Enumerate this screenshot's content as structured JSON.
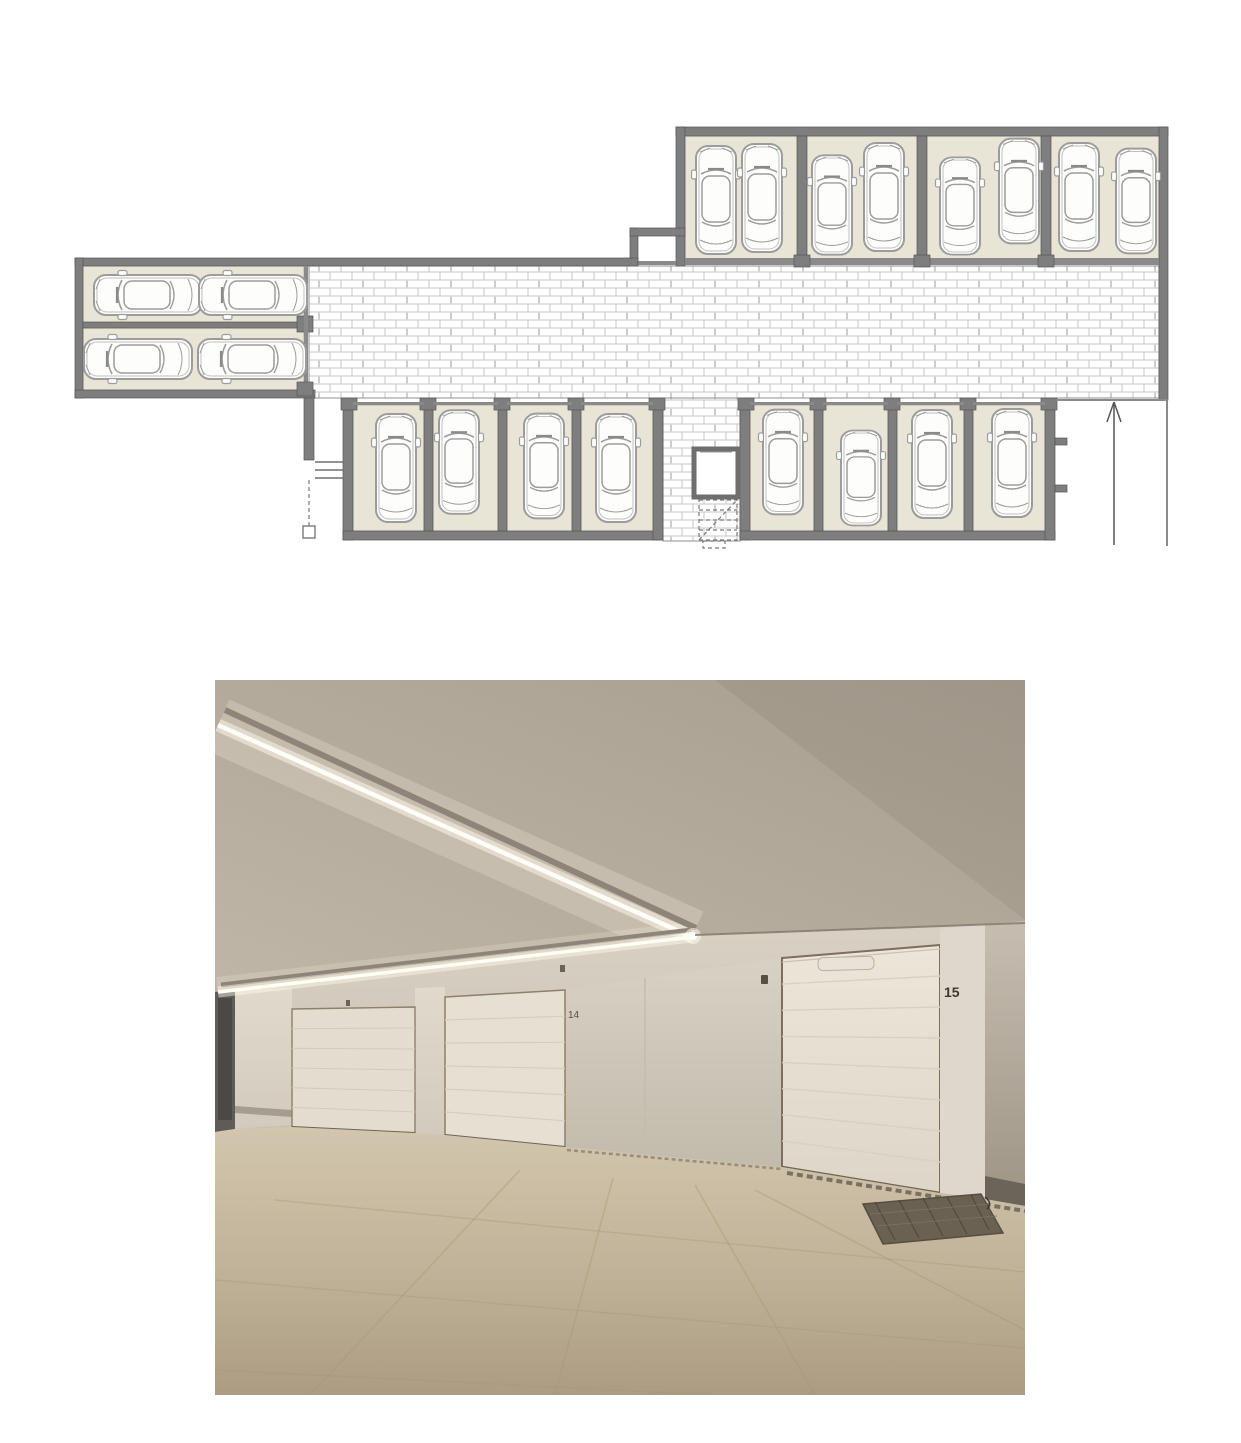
{
  "page": {
    "background": "#ffffff"
  },
  "floor_plan": {
    "kind": "garage parking level plan",
    "colors": {
      "wall": "#7e7e7e",
      "wall_dark": "#565656",
      "thin_wall": "#8a8a8a",
      "stall_fill": "#e9e5d6",
      "stall_edge": "#aca795",
      "car_line": "#9c9c9c",
      "hatch_line": "#c6c6c6",
      "paper": "#ffffff"
    },
    "stalls": {
      "top_row_bays": 4,
      "top_row_cars": 8,
      "left_wing_rooms": 2,
      "left_wing_cars": 4,
      "bottom_left_boxes": 4,
      "bottom_right_boxes": 4,
      "total_cars": 20
    },
    "cars": [
      [
        716,
        200,
        0,
        1
      ],
      [
        762,
        198,
        0,
        1
      ],
      [
        832,
        205,
        0,
        0.92
      ],
      [
        884,
        197,
        0,
        1
      ],
      [
        960,
        206,
        0,
        0.9
      ],
      [
        1019,
        191,
        0,
        0.97
      ],
      [
        1079,
        197,
        0,
        1
      ],
      [
        1136,
        201,
        0,
        0.97
      ],
      [
        148,
        295,
        270,
        1
      ],
      [
        253,
        295,
        270,
        1
      ],
      [
        138,
        359,
        270,
        1
      ],
      [
        252,
        359,
        270,
        1
      ],
      [
        396,
        468,
        0,
        1
      ],
      [
        459,
        462,
        0,
        0.96
      ],
      [
        544,
        466,
        0,
        0.97
      ],
      [
        616,
        468,
        0,
        1
      ],
      [
        783,
        462,
        0,
        0.97
      ],
      [
        861,
        478,
        0,
        0.88
      ],
      [
        932,
        464,
        0,
        1
      ],
      [
        1012,
        463,
        0,
        1
      ]
    ],
    "features": {
      "elevator": true,
      "staircase": true,
      "ramp_arrow_direction": "up"
    }
  },
  "photo": {
    "scene": "underground garage interior, white sectional doors, angled LED strip ceiling light",
    "doors": [
      {
        "number": ""
      },
      {
        "number": "14"
      },
      {
        "number": "15"
      }
    ],
    "colors": {
      "ceiling_light": "#c0b6a8",
      "ceiling_dark": "#a89e90",
      "wall": "#cfc8ba",
      "door_face": "#eae4d8",
      "door_frame": "#7d6f5c",
      "floor_light": "#d2c6ae",
      "floor_dark": "#ab9c82",
      "led": "#fffdf4",
      "number": "#3e382f"
    }
  }
}
